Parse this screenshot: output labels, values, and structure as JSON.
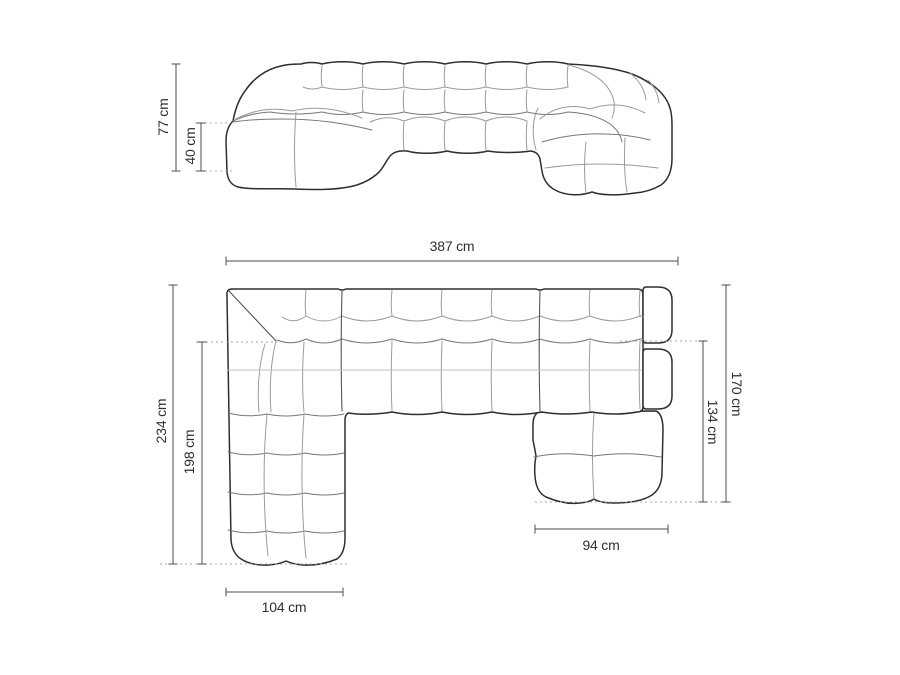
{
  "page": {
    "background": "#ffffff"
  },
  "diagram": {
    "title": "U-shaped modular sofa dimensions",
    "unit": "cm",
    "views": {
      "front": {
        "name": "front-elevation",
        "dimensions": {
          "total_height": "77 cm",
          "seat_height": "40 cm"
        }
      },
      "top": {
        "name": "top-plan",
        "dimensions": {
          "total_width": "387 cm",
          "left_depth_total": "234 cm",
          "left_depth_chaise": "198 cm",
          "right_depth_total": "170 cm",
          "right_depth_chaise": "134 cm",
          "left_chaise_width": "104 cm",
          "right_chaise_width": "94 cm"
        }
      }
    },
    "colors": {
      "outline": "#2e2e2e",
      "seam": "#9b9b9b",
      "dimension_line": "#4d4d4d",
      "leader_dotted": "#a8a8a8",
      "label_text": "#2f2f2f",
      "background": "#ffffff"
    }
  }
}
